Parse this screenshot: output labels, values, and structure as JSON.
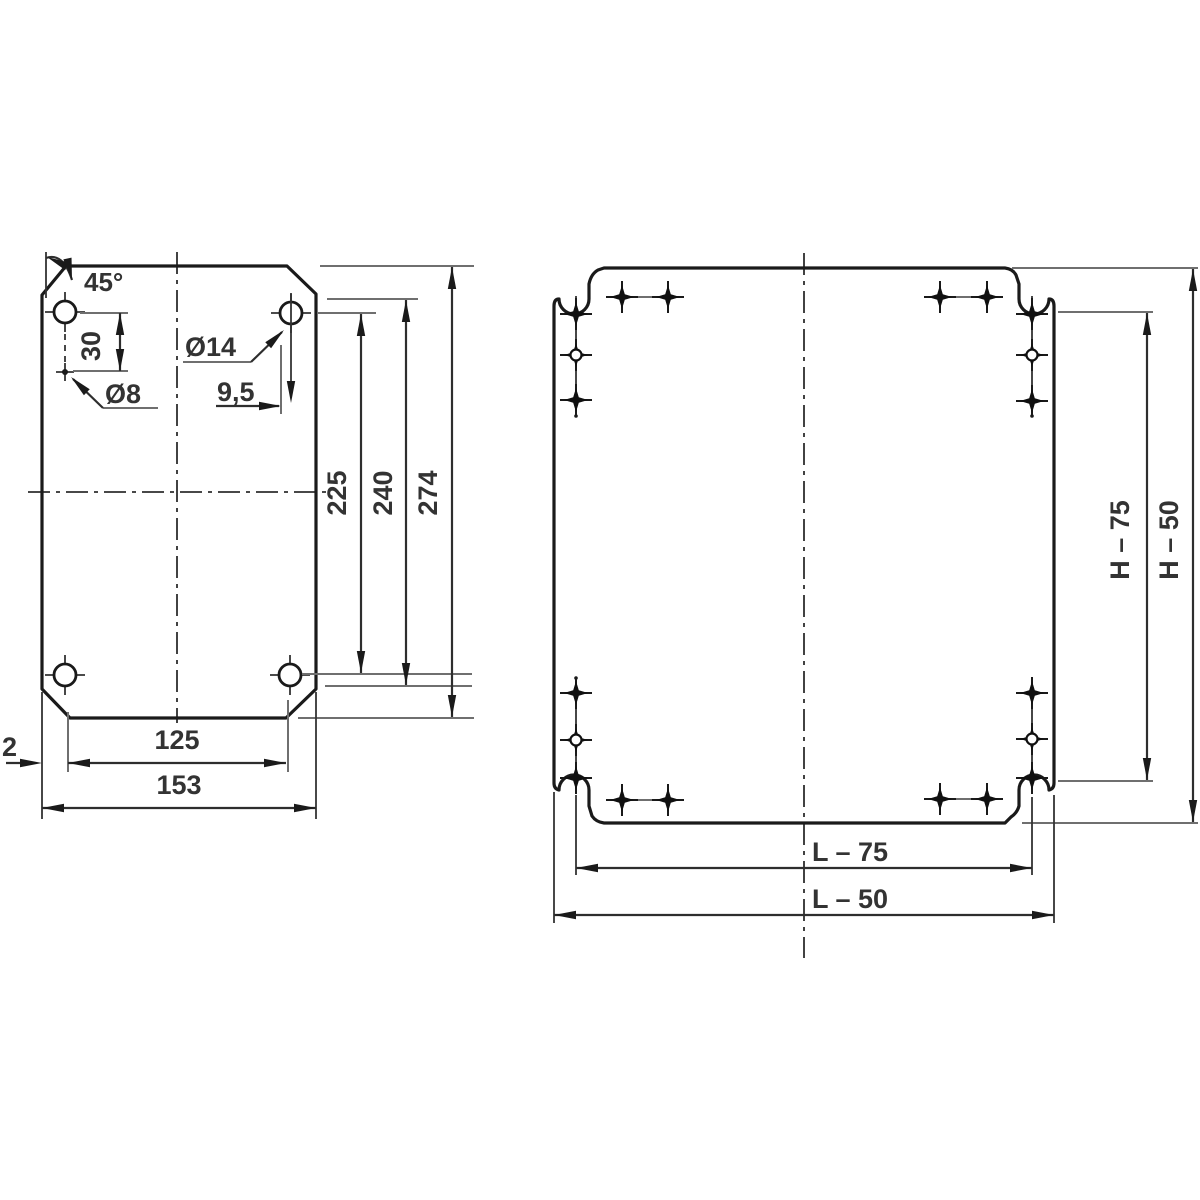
{
  "colors": {
    "ink": "#1a1a1a",
    "dimension_line": "#2e2e2e",
    "extension_line": "#6f6f6f",
    "text": "#333333",
    "background": "#ffffff"
  },
  "left_view": {
    "angle_label": "45°",
    "vertical_hole_offset": "30",
    "large_hole_dia": "Ø14",
    "small_hole_dia": "Ø8",
    "edge_offset": "9,5",
    "hole_pitch_height": "225",
    "slot_height": "240",
    "plate_height": "274",
    "side_gap": "2",
    "bottom_edge_width": "125",
    "plate_width": "153"
  },
  "right_view": {
    "hole_pitch_height": "H – 75",
    "plate_height": "H – 50",
    "hole_pitch_width": "L – 75",
    "plate_width": "L – 50"
  }
}
